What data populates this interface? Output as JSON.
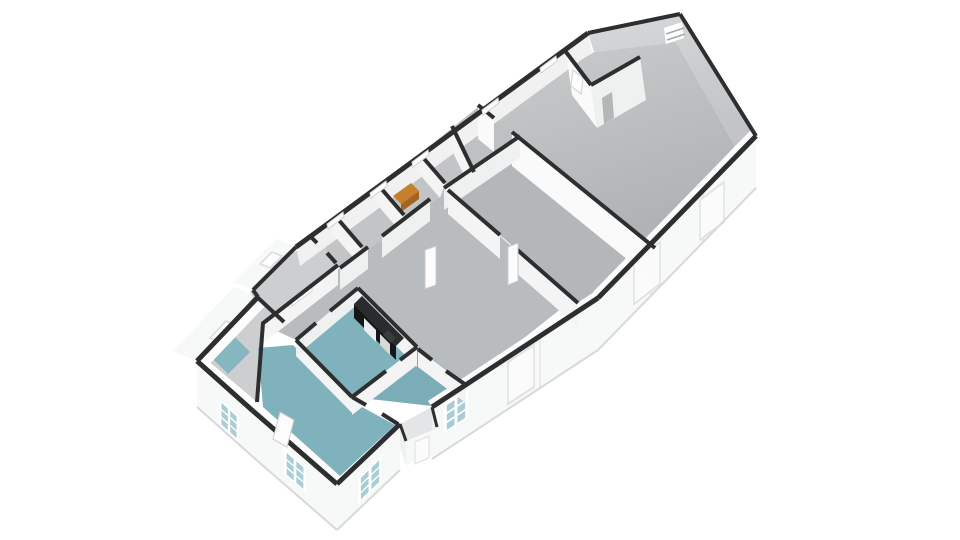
{
  "scene": {
    "type": "3d-floorplan-isometric-render",
    "background": "#ffffff",
    "storeys": 1,
    "orientation": "long-axis lower-left to upper-right, gable end at upper-right"
  },
  "palette": {
    "bg": "#ffffff",
    "wall_dark": "#2d2e30",
    "wall_dark_soft": "#3a3b3d",
    "ext_face": "#f7f8f8",
    "ext_face_shade": "#eff0f1",
    "ext_bottom_edge": "#d8d9da",
    "seam": "#e9eaeb",
    "inner_band": "#f1f1f2",
    "inner_lip": "#fdfdfe",
    "face_white": "#fafafb",
    "face_light": "#f4f4f5",
    "face_mid": "#eff0f0",
    "gable_face_hi": "#d3d5d6",
    "floor_gray": "#b9bcbe",
    "floor_gray_dark": "#b4b7b9",
    "floor_gray_mid": "#bec0c2",
    "floor_strip": "#c2c4c6",
    "floor_wing": "#ccced0",
    "floor_porch": "#e4e5e6",
    "floor_teal": "#7fb2bc",
    "floor_teal_2": "#7badb8",
    "floor_teal_3": "#86b6bf",
    "glass_teal": "#a8cdd4",
    "glass_light": "#eef4f5",
    "window_frame": "#ffffff",
    "window_mullion": "#a6a8aa",
    "door_leaf": "#fcfcfd",
    "door_edge": "#c9cacb",
    "opening_gray": "#b4b7b9",
    "counter_top": "#2a2b2c",
    "counter_front": "#151617",
    "appliance_a": "#ededee",
    "appliance_b": "#d8d8d9",
    "counter_item": "#3a3b3c",
    "cabinet_top": "#c5802e",
    "cabinet_front": "#a3641f"
  },
  "rooms": [
    {
      "id": "great-room",
      "floor": "floor_gray",
      "position": "upper-right under gable"
    },
    {
      "id": "middle-room",
      "floor": "floor_gray_dark",
      "position": "center"
    },
    {
      "id": "center-room",
      "floor": "floor_gray",
      "position": "center-left"
    },
    {
      "id": "hall-strip",
      "floor": "floor_strip",
      "position": "along upper-left edge"
    },
    {
      "id": "entry-vestibule",
      "floor": "floor_gray_mid",
      "position": "between hall and great room"
    },
    {
      "id": "kitchen",
      "floor": "floor_teal",
      "fixtures": [
        "black-counter",
        "appliances"
      ]
    },
    {
      "id": "shower-room",
      "floor": "floor_teal_2",
      "position": "below kitchen"
    },
    {
      "id": "rear-room",
      "floor": "floor_teal",
      "position": "lower-left end"
    },
    {
      "id": "side-wing",
      "floor": "floor_wing",
      "position": "far left wing"
    },
    {
      "id": "wing-wet-strip",
      "floor": "floor_teal_3",
      "position": "inside wing"
    }
  ],
  "fixtures": {
    "kitchen_counter": "black counter with white appliance fronts",
    "orange_cabinet": "small orange sideboard in hall room",
    "open_door_leaves": 3,
    "paned_windows": 5,
    "slit_windows": 6,
    "gable_skylight": 1,
    "faint_exterior_doors": 3
  }
}
